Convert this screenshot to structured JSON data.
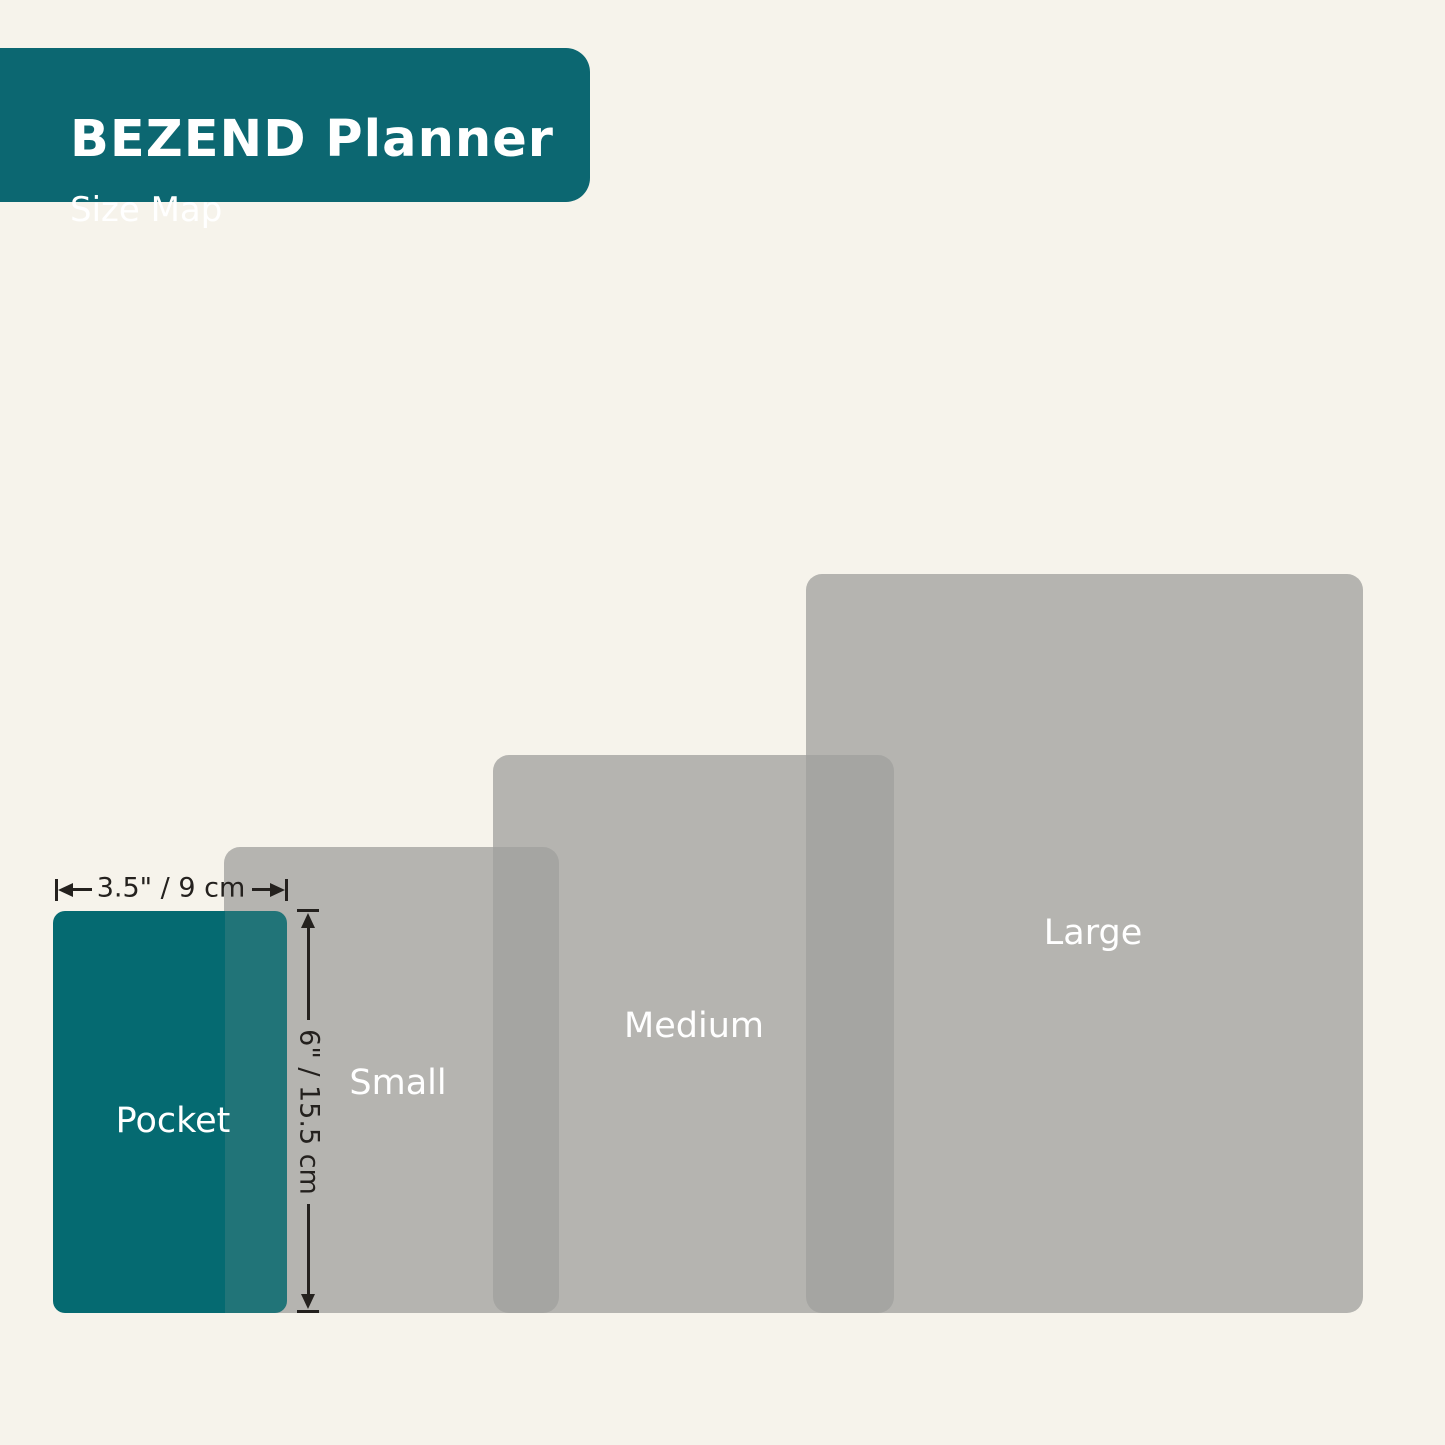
{
  "header": {
    "title": "BEZEND Planner",
    "subtitle": "Size Map"
  },
  "sizes": {
    "pocket": {
      "label": "Pocket"
    },
    "small": {
      "label": "Small"
    },
    "medium": {
      "label": "Medium"
    },
    "large": {
      "label": "Large"
    }
  },
  "dimensions": {
    "width_label": "3.5\" / 9 cm",
    "height_label": "6\" / 15.5 cm"
  },
  "colors": {
    "background": "#F6F3EB",
    "brand_teal": "#0C6771",
    "pocket_teal": "#056A71",
    "pocket_overlap_teal": "#217478",
    "rect_gray": "rgba(161,160,158,0.76)",
    "label_text": "#FFFFFF",
    "dimension_ink": "#24211E"
  }
}
